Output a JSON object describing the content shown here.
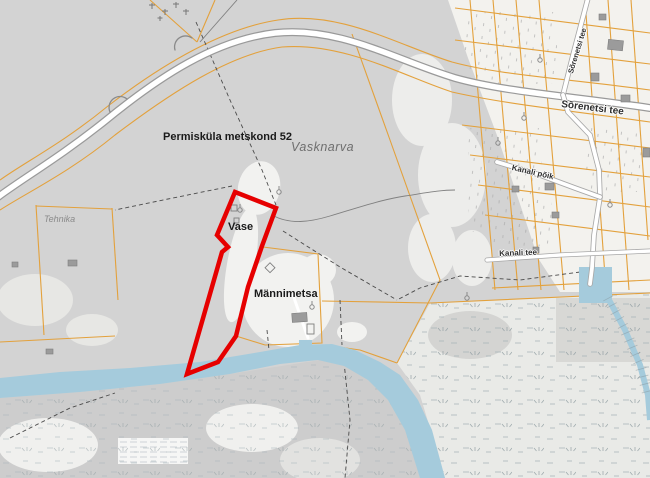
{
  "map": {
    "place_labels": {
      "forest_block": {
        "text": "Permisküla metskond 52"
      },
      "village": {
        "text": "Vasknarva"
      },
      "vase": {
        "text": "Vase"
      },
      "mannimetsa": {
        "text": "Männimetsa"
      },
      "tehnika": {
        "text": "Tehnika"
      }
    },
    "road_labels": {
      "sorenetsi_main": {
        "text": "Sõrenetsi tee"
      },
      "sorenetsi_north": {
        "text": "Sõrenetsi tee"
      },
      "kanali_poik": {
        "text": "Kanali põik"
      },
      "kanali_tee": {
        "text": "Kanali tee"
      }
    },
    "highlight": {
      "kind": "selected-parcel-outline",
      "color": "#e60000"
    },
    "colors": {
      "forest_gray": "#d3d3d3",
      "clearing_white": "#f2f2f0",
      "cadastral_orange": "#e3a13c",
      "water_blue": "#a5cbdc",
      "road_fill": "#ffffff",
      "road_casing": "#9a9a9a",
      "marsh_base": "#e9eae7"
    }
  }
}
